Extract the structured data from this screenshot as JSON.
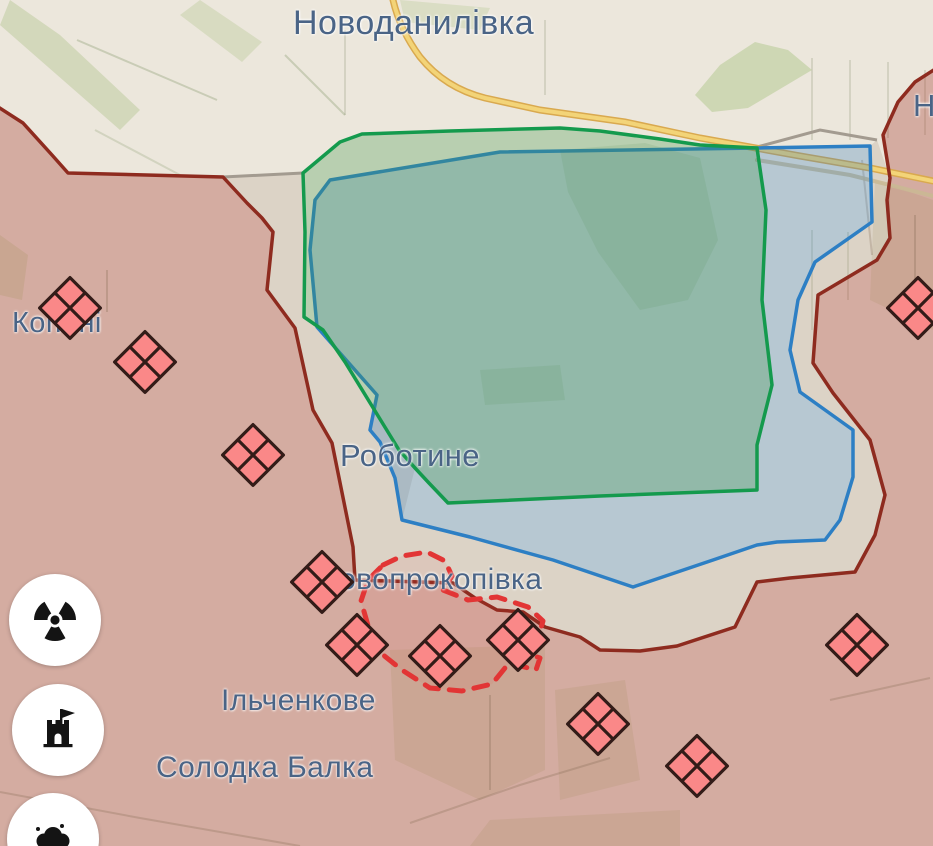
{
  "labels": {
    "novodanylivka": "Новоданилівка",
    "city_partial": "Н",
    "kopani": "Копані",
    "robotyne": "Роботине",
    "novoprokopivka": "Новопрокопівка",
    "ilchenkove": "Ільченкове",
    "solodka_balka": "Солодка Балка"
  },
  "colors": {
    "base_terrain": "#ece7dc",
    "russian_control_overlay": "rgba(168,62,52,0.35)",
    "front_line": "#8e2b1f",
    "liberated_area_fill": "rgba(62,152,75,0.30)",
    "liberated_area_stroke": "#149a4d",
    "advance_area_fill": "rgba(58,130,190,0.30)",
    "advance_area_stroke": "#2d7fc4",
    "contested_dash": "#e23535",
    "unit_marker_fill": "#fa8888",
    "unit_marker_stroke": "#331c18",
    "road": "#f3d478",
    "label_text": "#4a6486",
    "old_front_gray_line": "#a39b90"
  },
  "map": {
    "unit_marker_icon": "armored-unit-diamond-icon",
    "unit_marker_half_size": 21.5,
    "unit_markers": [
      {
        "x": 70,
        "y": 308
      },
      {
        "x": 145,
        "y": 362
      },
      {
        "x": 253,
        "y": 455
      },
      {
        "x": 322,
        "y": 582
      },
      {
        "x": 357,
        "y": 645
      },
      {
        "x": 440,
        "y": 656
      },
      {
        "x": 518,
        "y": 640
      },
      {
        "x": 598,
        "y": 724
      },
      {
        "x": 697,
        "y": 766
      },
      {
        "x": 857,
        "y": 645
      },
      {
        "x": 918,
        "y": 308
      }
    ],
    "control_buttons": [
      {
        "name": "radiation-button",
        "icon": "radiation-icon"
      },
      {
        "name": "fortification-button",
        "icon": "castle-icon"
      },
      {
        "name": "strikes-button",
        "icon": "explosion-cloud-icon"
      }
    ]
  }
}
